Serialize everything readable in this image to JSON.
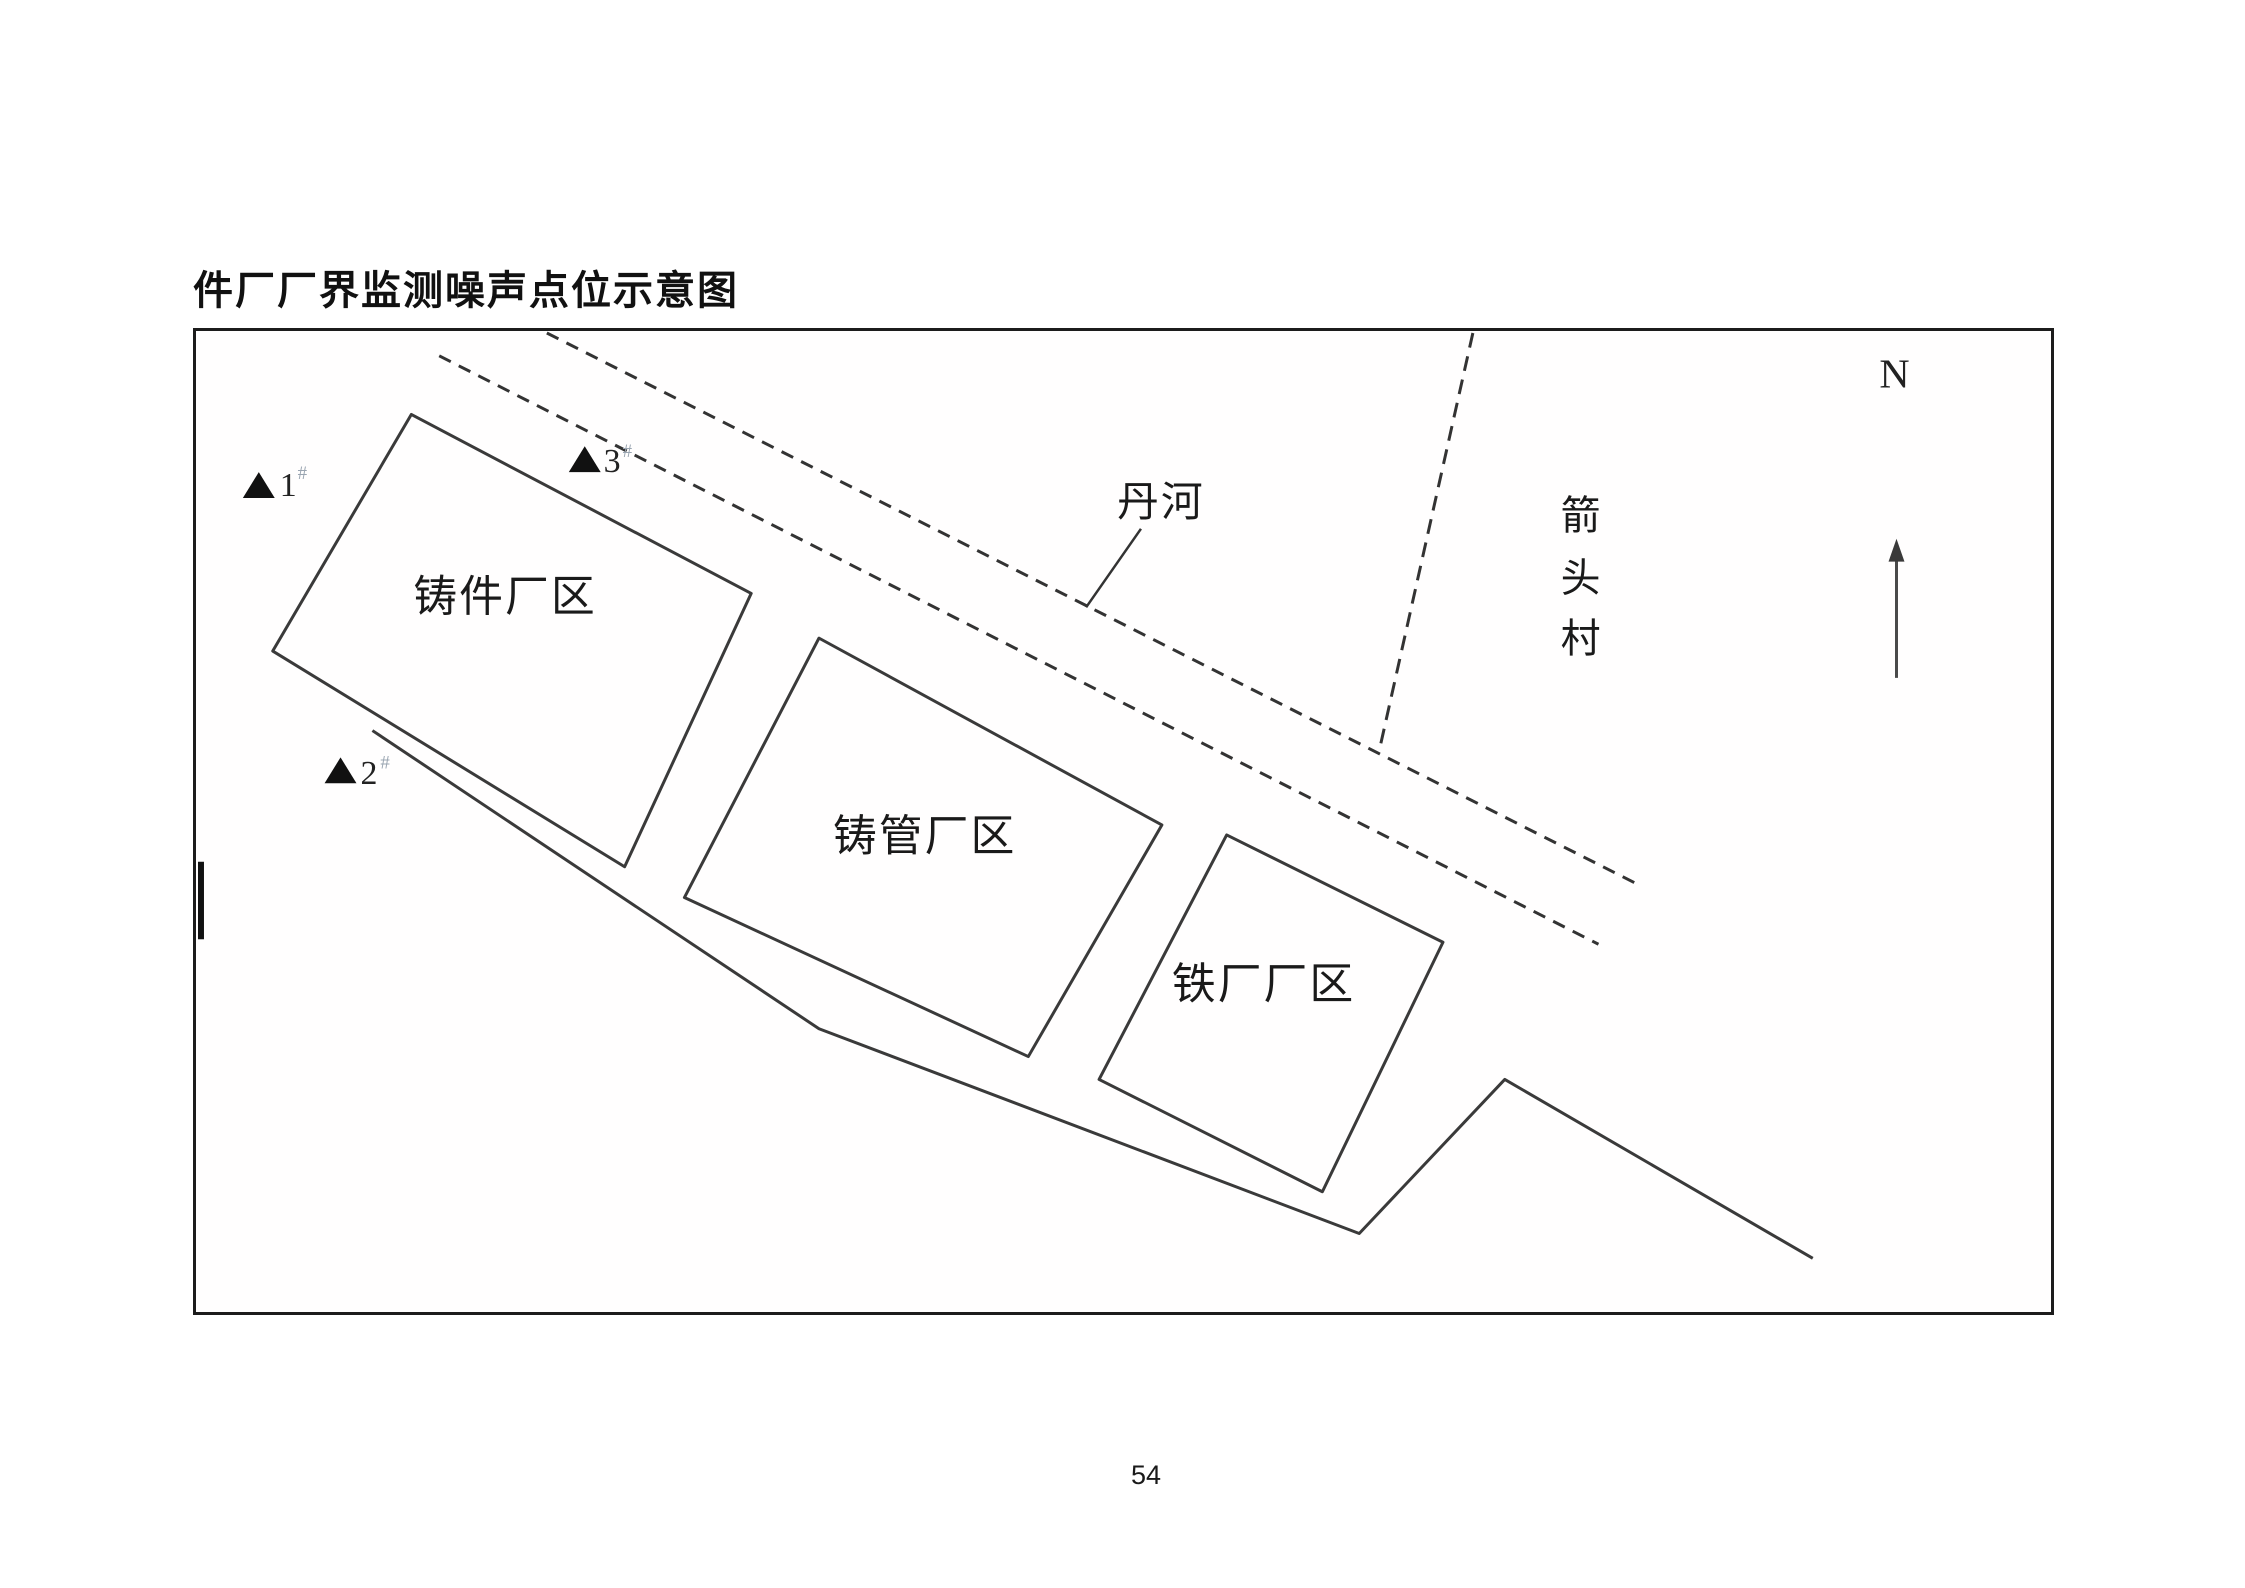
{
  "document": {
    "title": "件厂厂界监测噪声点位示意图",
    "page_number": "54"
  },
  "diagram": {
    "compass": {
      "label": "N"
    },
    "river": {
      "label": "丹河"
    },
    "village": {
      "char1": "箭",
      "char2": "头",
      "char3": "村"
    },
    "factories": [
      {
        "name": "铸件厂区"
      },
      {
        "name": "铸管厂区"
      },
      {
        "name": "铁厂厂区"
      }
    ],
    "markers": [
      {
        "num": "1",
        "suffix": "#"
      },
      {
        "num": "2",
        "suffix": "#"
      },
      {
        "num": "3",
        "suffix": "#"
      }
    ],
    "colors": {
      "ink": "#333333",
      "marker_fill": "#111111",
      "suffix_gray": "#9aa5b1",
      "north_arrow": "#4a4a4a"
    }
  }
}
